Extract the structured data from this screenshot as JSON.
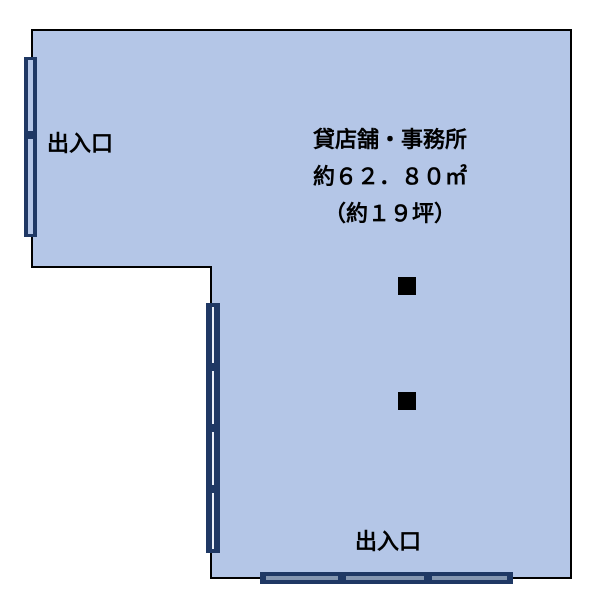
{
  "floorplan": {
    "property": {
      "title": "貸店舗・事務所",
      "area": "約６２．８０㎡",
      "tsubo": "（約１９坪）"
    },
    "labels": {
      "entrance_left": "出入口",
      "entrance_bottom": "出入口"
    },
    "icons": {
      "pillar": "black-square",
      "left_fixture": "double-sliding-door",
      "inner_wall_fixture": "four-panel-window",
      "bottom_fixture": "three-panel-sliding-door"
    },
    "colors": {
      "room_fill": "#b4c6e7",
      "wall_outline": "#000000",
      "fixture_dark": "#1f3864",
      "fixture_light": "#8496b0",
      "pillar": "#000000",
      "background": "#ffffff"
    }
  }
}
